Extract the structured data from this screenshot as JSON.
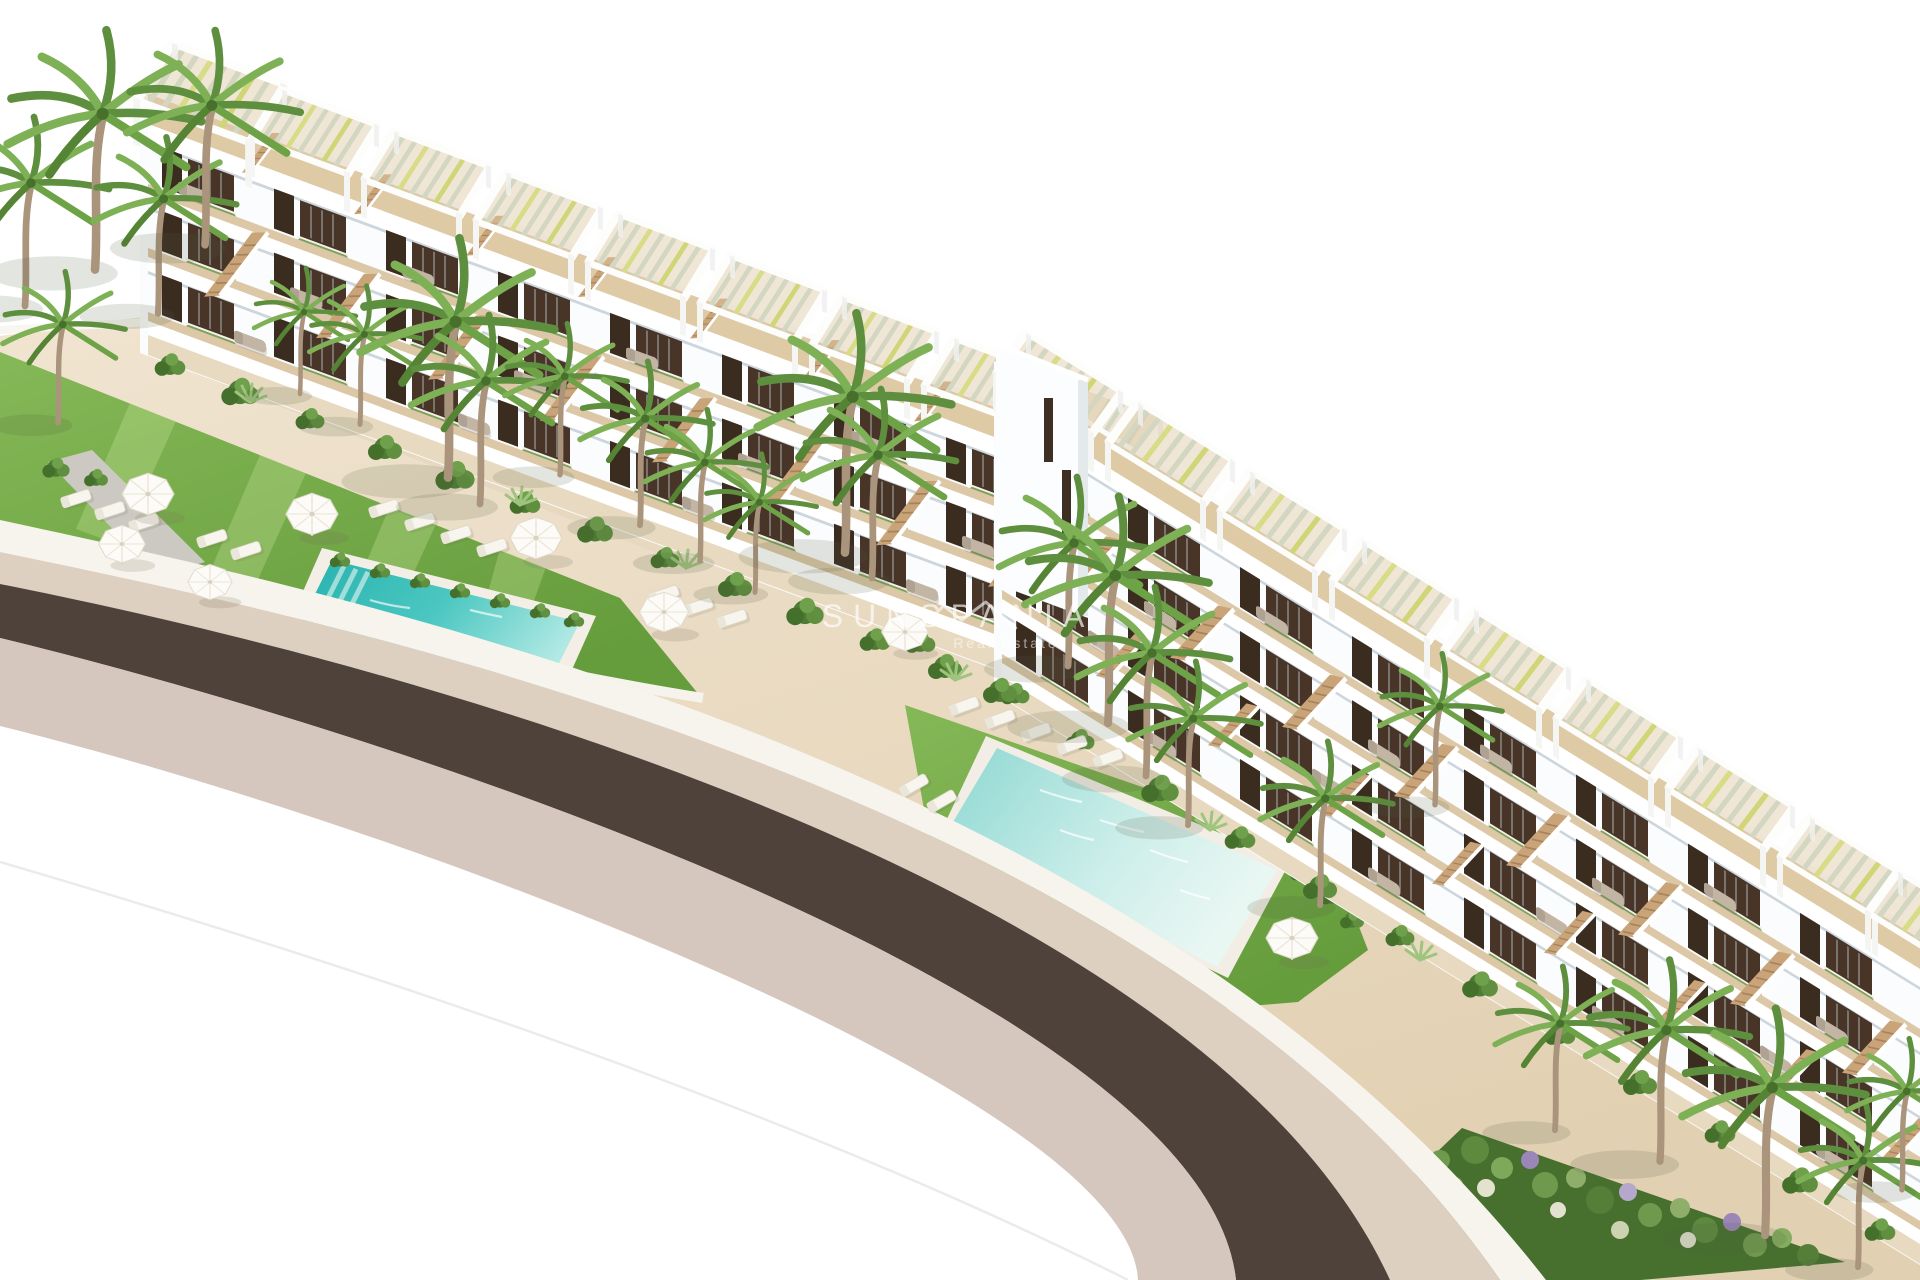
{
  "watermark": {
    "brand": "SUNSPANIA",
    "tagline": "Real Estate",
    "icon": "mountain-peaks-icon"
  },
  "scene": {
    "type": "architectural-aerial-render",
    "description": "Aerial 3D render of a white terraced apartment complex with rooftop pergola terraces, wooden staircases, tropical gardens, sun umbrellas and loungers, two turquoise lap pools and a curved dark asphalt road on a white background",
    "sky": "#ffffff"
  },
  "elements": {
    "left_building_pergolas": 9,
    "right_building_pergolas": 9,
    "pools": 2,
    "umbrellas": 8
  },
  "palette": {
    "building_white": "#fbfcfd",
    "terrace_wood": "#dfcaa6",
    "window_dark": "#483528",
    "door_dark": "#3b2c20",
    "lawn_green": "#74aa48",
    "shrub_green": "#4f7c34",
    "pool_teal": "#2fbcb6",
    "pool_pale": "#c9efec",
    "pavement_beige": "#e9dcc3",
    "road_asphalt": "#4e423b",
    "sidewalk_pink": "#d6c7be",
    "sidewalk_beige": "#ddd0c0",
    "curb_white": "#f7f4ed",
    "palm_trunk": "#ab947c",
    "palm_frond": "#5e8f3e",
    "stair_wood": "#c9a479",
    "umbrella_white": "#fcfbf7"
  }
}
